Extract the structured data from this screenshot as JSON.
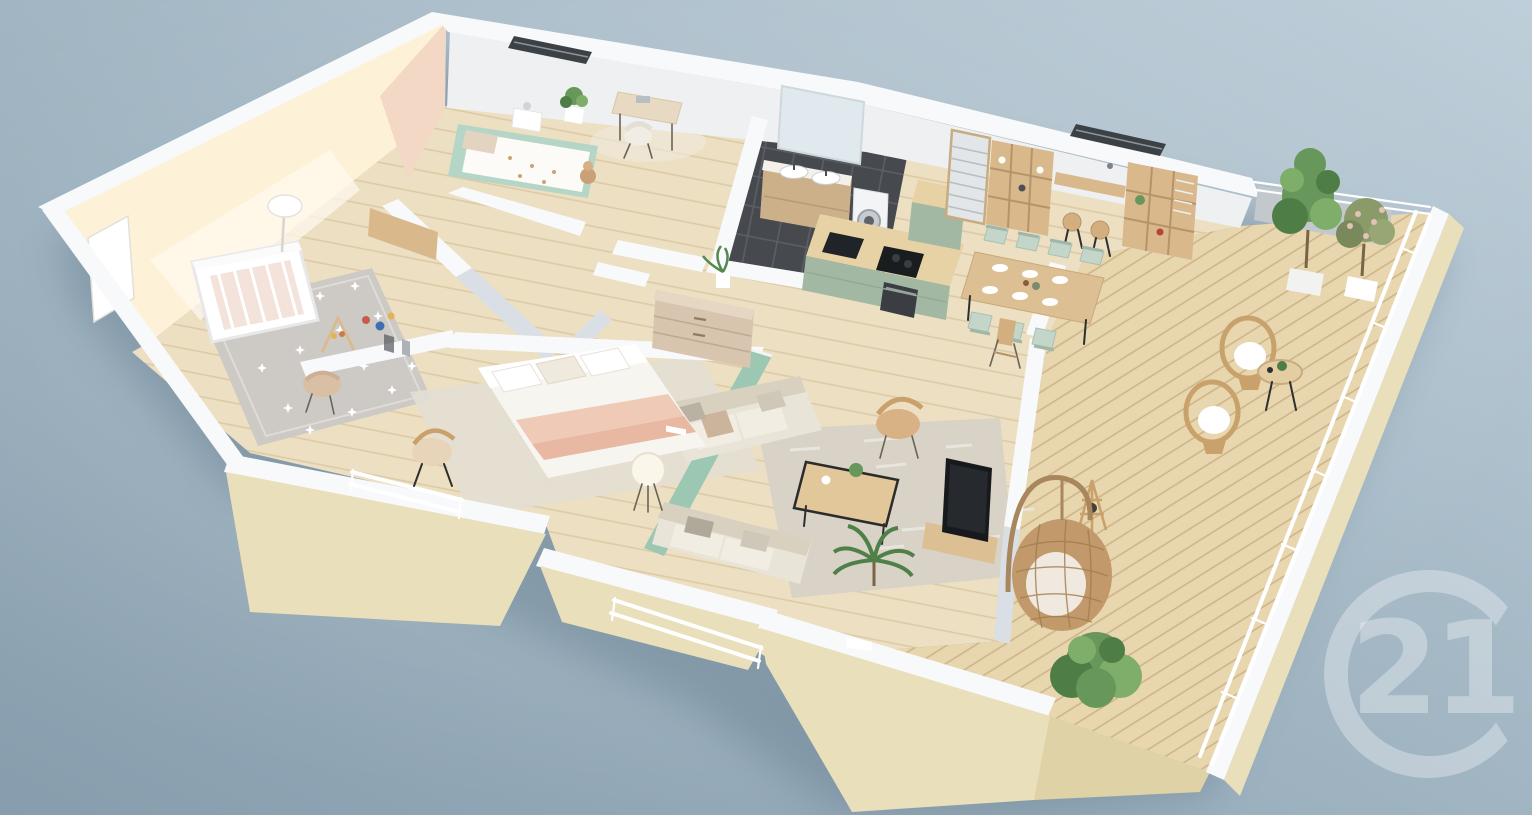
{
  "scene": {
    "description": "3D isometric cutaway floor plan render of a furnished attic apartment with a wraparound wooden terrace, shown on a blue-gray gradient background",
    "projection": "isometric cutaway (dollhouse view)",
    "background": {
      "top_right": "#bdcdd8",
      "bottom_left": "#879dad"
    }
  },
  "watermark": {
    "number": "21",
    "icon": "c-ring-monogram",
    "color": "#ffffff",
    "opacity": 0.33,
    "position": "bottom-right, clipped by edge"
  },
  "palette": {
    "wall_white": "#f8f9fa",
    "wall_shadow": "#d9dfe5",
    "facade_cream": "#e9dfba",
    "nursery_wall_cream": "#fdf2d8",
    "accent_peach": "#f3d8c5",
    "accent_mint_wall": "#9cc7b3",
    "kitchen_sage": "#a3b8a3",
    "kid_bed_mint": "#b5d6c6",
    "floor_wood": "#ecdfc2",
    "deck_wood": "#e7d6ae",
    "bathroom_tile": "#46494d",
    "rug_gray": "#cdcac6",
    "rattan": "#c9a26b",
    "plant_green": "#4e7d46",
    "shadow_blue": "#5f7788"
  },
  "rooms": [
    {
      "name": "nursery",
      "features": [
        "cream accent wall",
        "white crib",
        "gray star rug",
        "floor lamp",
        "toddler chair",
        "play gym",
        "toys",
        "open wardrobe"
      ]
    },
    {
      "name": "kids-bedroom",
      "features": [
        "peach accent wall",
        "mint single bed with patterned duvet",
        "nightstand with lamp",
        "desk with chair",
        "potted plant",
        "teddy bear",
        "skylight"
      ]
    },
    {
      "name": "bathroom",
      "features": [
        "dark tile floor",
        "wood double-sink vanity",
        "large mirror",
        "washing machine"
      ]
    },
    {
      "name": "kitchen",
      "features": [
        "sage green island with black cooktop and sink",
        "built-in oven",
        "tall sage cabinet",
        "wood shelving with louvered doors",
        "wall bar shelf",
        "bar stools"
      ]
    },
    {
      "name": "dining-area",
      "features": [
        "long wood table with tableware",
        "mint dining chairs",
        "wooden high chair",
        "skylight"
      ]
    },
    {
      "name": "living-room",
      "features": [
        "mint accent wall",
        "two beige sofas",
        "wood coffee table with black frame",
        "patterned gray rug",
        "TV on wood console",
        "rattan armchair",
        "potted palm"
      ]
    },
    {
      "name": "master-bedroom",
      "features": [
        "double bed with pink throw",
        "light rug",
        "rattan chair",
        "tripod floor lamp",
        "french balcony railing"
      ]
    },
    {
      "name": "hallway-dressing",
      "features": [
        "beige chest of drawers",
        "plant",
        "white partition walls"
      ]
    },
    {
      "name": "terrace",
      "features": [
        "wood deck planks",
        "white railings",
        "two rattan lounge chairs",
        "bistro table",
        "hanging egg chair",
        "bamboo floor lamp",
        "potted trees",
        "green shrub",
        "cream parapet walls"
      ]
    }
  ]
}
